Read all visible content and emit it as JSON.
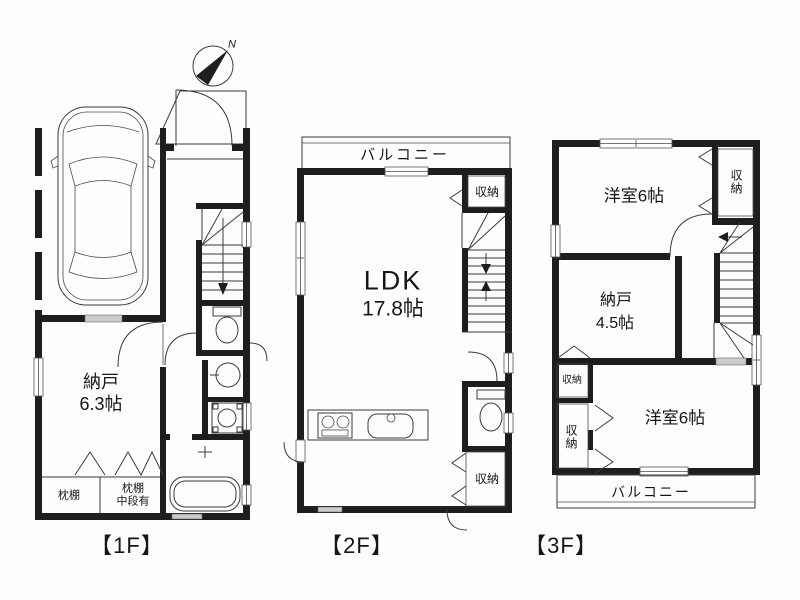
{
  "colors": {
    "wall": "#1e1e1e",
    "line": "#3c3c3c",
    "background": "#ffffff"
  },
  "floor1": {
    "label": "【1F】",
    "compass_north": "N",
    "storage": {
      "name": "納戸",
      "size": "6.3帖"
    },
    "closet_left_label": "枕棚",
    "closet_right_line1": "枕棚",
    "closet_right_line2": "中段有"
  },
  "floor2": {
    "label": "【2F】",
    "balcony_label": "バルコニー",
    "closet_top_label": "収納",
    "ldk": {
      "name": "LDK",
      "size": "17.8帖"
    },
    "closet_bottom_label": "収納"
  },
  "floor3": {
    "label": "【3F】",
    "bedroom_top_label": "洋室6帖",
    "closet_top_right_label": "収納",
    "storage": {
      "name": "納戸",
      "size": "4.5帖"
    },
    "closet_mid_label": "収納",
    "closet_left_label": "収納",
    "bedroom_bottom_label": "洋室6帖",
    "balcony_label": "バルコニー"
  }
}
